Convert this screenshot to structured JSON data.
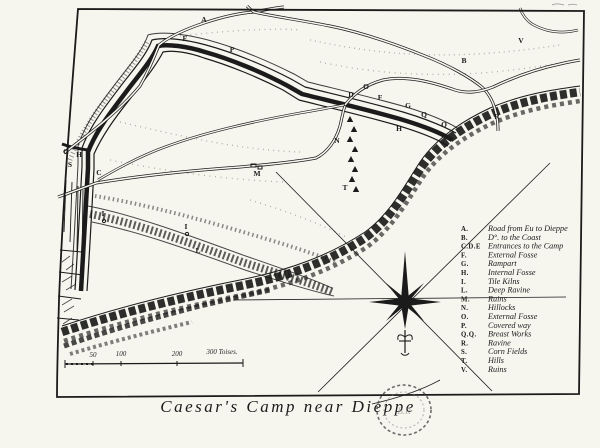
{
  "title": {
    "text": "Caesar's Camp near Dieppe"
  },
  "stamp": {
    "text": "B.R"
  },
  "legend": {
    "entries": [
      {
        "key": "A.",
        "label": "Road from Eu to Dieppe"
      },
      {
        "key": "B.",
        "label": "D°. to the Coast"
      },
      {
        "key": "C.D.E",
        "label": "Entrances to the Camp"
      },
      {
        "key": "F.",
        "label": "External Fosse"
      },
      {
        "key": "G.",
        "label": "Rampart"
      },
      {
        "key": "H.",
        "label": "Internal Fosse"
      },
      {
        "key": "I.",
        "label": "Tile Kilns"
      },
      {
        "key": "L.",
        "label": "Deep Ravine"
      },
      {
        "key": "M.",
        "label": "Ruins"
      },
      {
        "key": "N.",
        "label": "Hillocks"
      },
      {
        "key": "O.",
        "label": "External Fosse"
      },
      {
        "key": "P.",
        "label": "Covered way"
      },
      {
        "key": "Q.Q.",
        "label": "Breast Works"
      },
      {
        "key": "R.",
        "label": "Ravine"
      },
      {
        "key": "S.",
        "label": "Corn Fields"
      },
      {
        "key": "T.",
        "label": "Hills"
      },
      {
        "key": "V.",
        "label": "Ruins"
      }
    ]
  },
  "scale_bar": {
    "labels": [
      "50",
      "100",
      "200",
      "300 Toises."
    ]
  },
  "map_labels": [
    {
      "t": "A",
      "x": 204,
      "y": 22
    },
    {
      "t": "P",
      "x": 232,
      "y": 52
    },
    {
      "t": "E",
      "x": 185,
      "y": 41
    },
    {
      "t": "B",
      "x": 464,
      "y": 63
    },
    {
      "t": "V",
      "x": 521,
      "y": 43
    },
    {
      "t": "O",
      "x": 366,
      "y": 89
    },
    {
      "t": "D",
      "x": 351,
      "y": 97
    },
    {
      "t": "F",
      "x": 380,
      "y": 100
    },
    {
      "t": "G",
      "x": 408,
      "y": 108
    },
    {
      "t": "Q",
      "x": 424,
      "y": 117
    },
    {
      "t": "Q",
      "x": 444,
      "y": 127
    },
    {
      "t": "H",
      "x": 399,
      "y": 131
    },
    {
      "t": "R",
      "x": 497,
      "y": 119
    },
    {
      "t": "N",
      "x": 337,
      "y": 143
    },
    {
      "t": "G",
      "x": 66,
      "y": 154
    },
    {
      "t": "H",
      "x": 79,
      "y": 157
    },
    {
      "t": "S",
      "x": 70,
      "y": 167
    },
    {
      "t": "C",
      "x": 99,
      "y": 175
    },
    {
      "t": "M",
      "x": 257,
      "y": 176
    },
    {
      "t": "T",
      "x": 345,
      "y": 190
    },
    {
      "t": "I",
      "x": 103,
      "y": 216
    },
    {
      "t": "I",
      "x": 186,
      "y": 229
    },
    {
      "t": "L",
      "x": 198,
      "y": 253
    }
  ]
}
